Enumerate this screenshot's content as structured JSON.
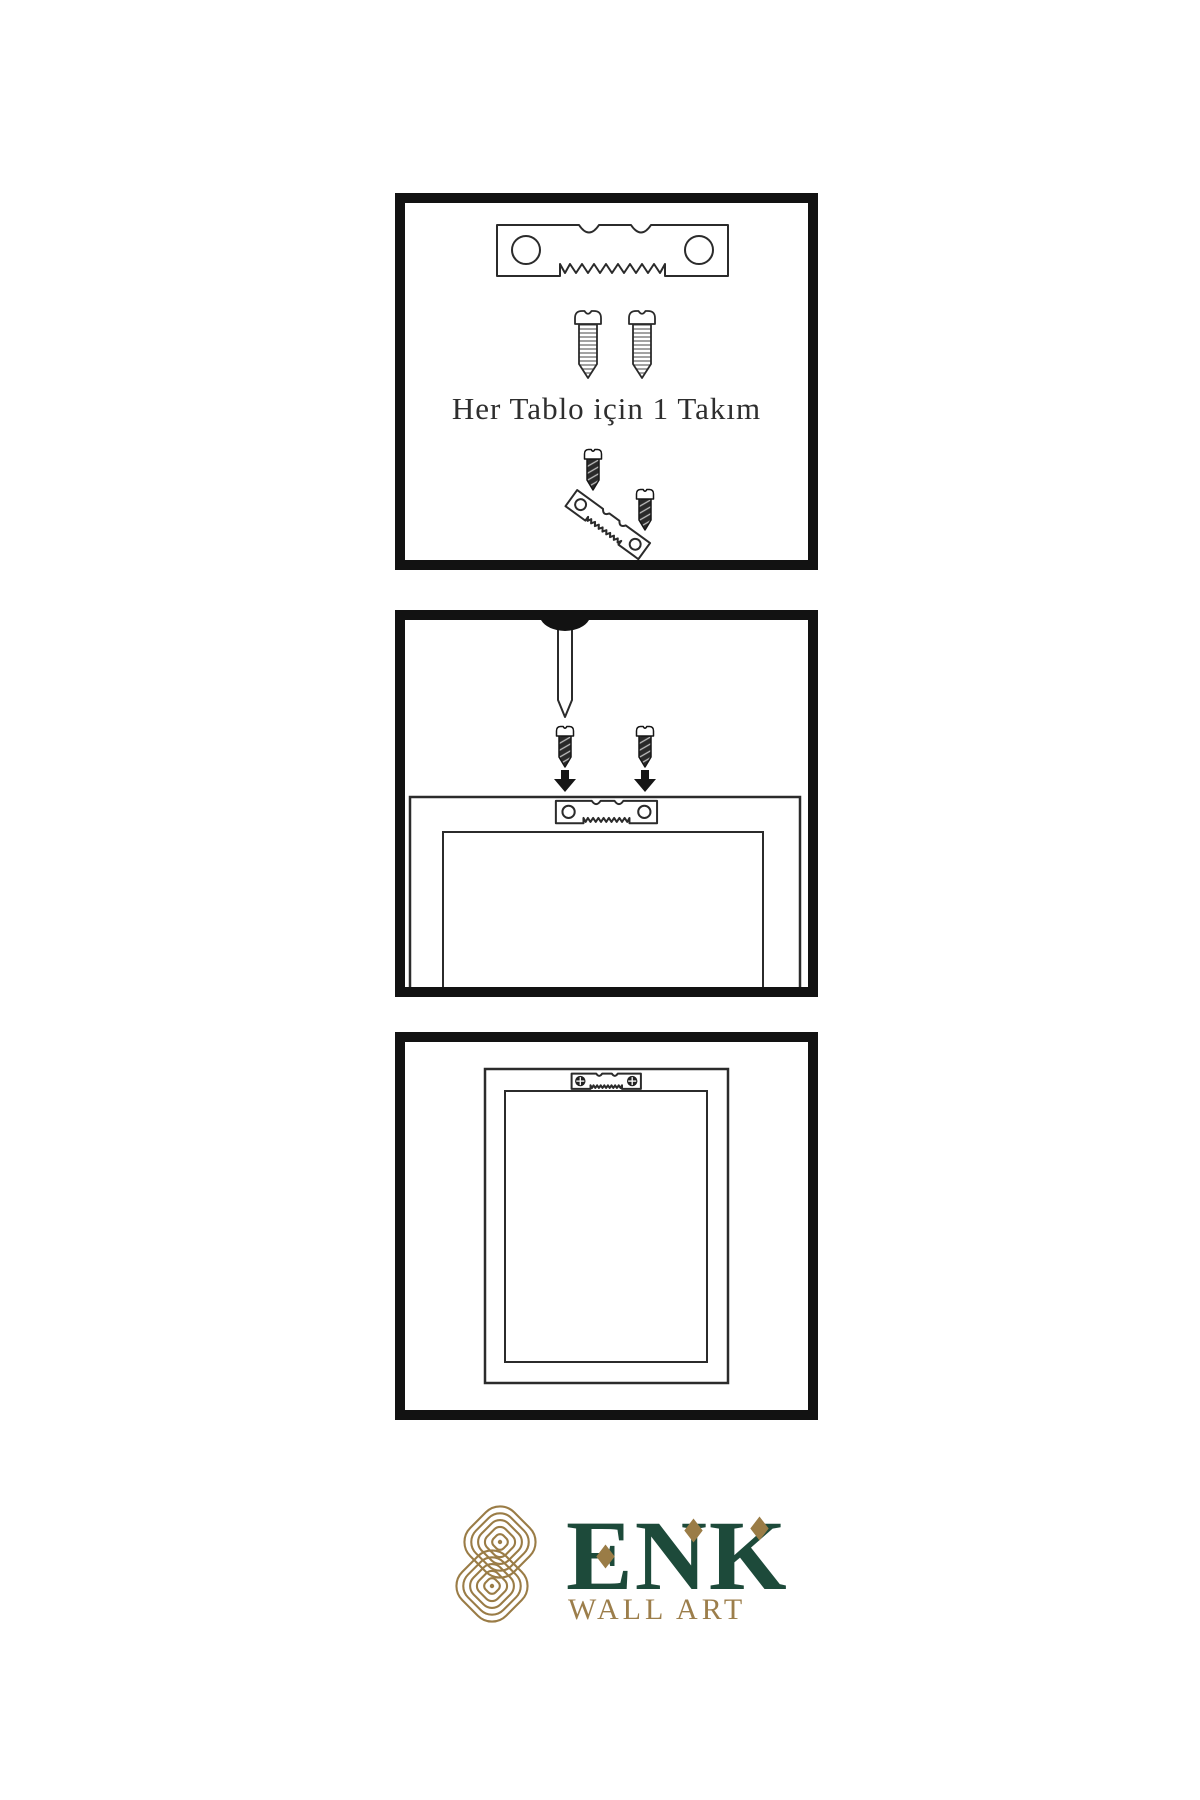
{
  "document": {
    "type": "wall-art-hanging-instructions",
    "background": "#ffffff"
  },
  "colors": {
    "panel_border": "#121212",
    "line_art": "#2b2b2b",
    "brand_green": "#1d4a3a",
    "brand_gold": "#9a7c46",
    "caption_text": "#2e2e2e"
  },
  "steps": [
    {
      "name": "hardware-kit",
      "caption": "Her Tablo için 1 Takım",
      "items": [
        "sawtooth-hanger",
        "screw",
        "screw",
        "screw-into-tilted-hanger",
        "screw"
      ]
    },
    {
      "name": "attach-hanger-to-frame",
      "items": [
        "wall-nail",
        "screw",
        "screw",
        "down-arrow",
        "down-arrow",
        "frame-back-top",
        "sawtooth-hanger"
      ]
    },
    {
      "name": "hang-frame-on-wall",
      "items": [
        "picture-frame",
        "sawtooth-hanger-with-screws"
      ]
    }
  ],
  "logo": {
    "brand": "ENK",
    "subtitle": "WALL ART",
    "emblem": "interlaced-knot"
  }
}
